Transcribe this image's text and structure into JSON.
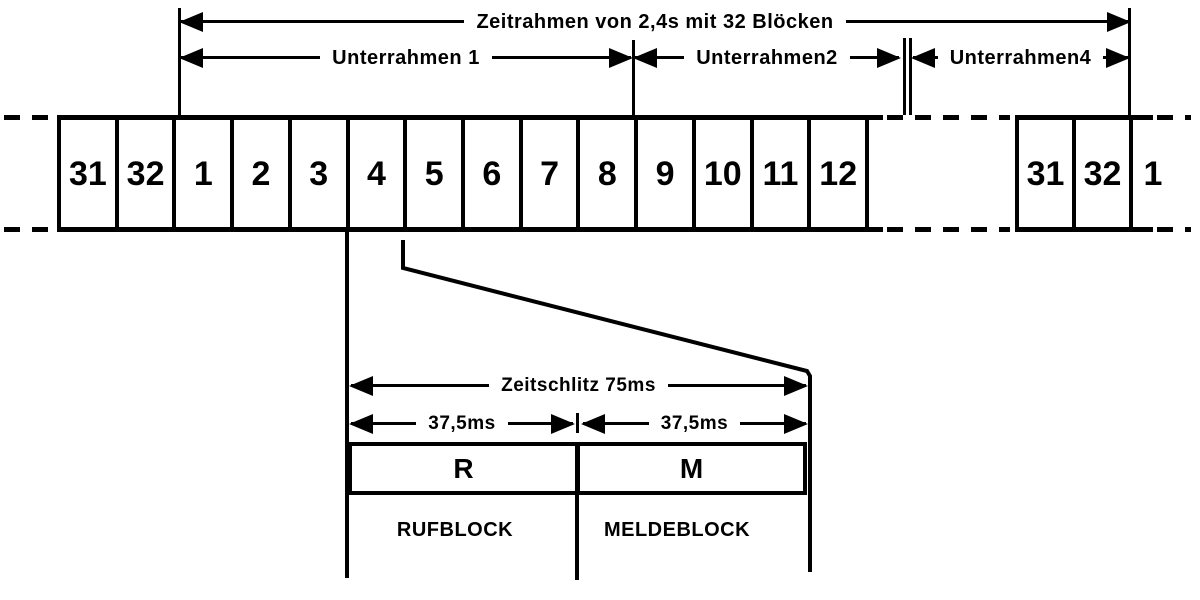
{
  "frame": {
    "title": "Zeitrahmen von 2,4s mit 32 Blöcken"
  },
  "subframes": {
    "sub1": "Unterrahmen 1",
    "sub2": "Unterrahmen2",
    "sub4": "Unterrahmen4"
  },
  "block_row": {
    "main": [
      "31",
      "32",
      "1",
      "2",
      "3",
      "4",
      "5",
      "6",
      "7",
      "8",
      "9",
      "10",
      "11",
      "12"
    ],
    "next_frame": [
      "31",
      "32",
      "1"
    ]
  },
  "timeslot": {
    "title": "Zeitschlitz 75ms",
    "first_half": "37,5ms",
    "second_half": "37,5ms",
    "call_block_symbol": "R",
    "message_block_symbol": "M",
    "call_block_name": "RUFBLOCK",
    "message_block_name": "MELDEBLOCK"
  },
  "colors": {
    "ink": "#000000",
    "background": "#ffffff"
  }
}
